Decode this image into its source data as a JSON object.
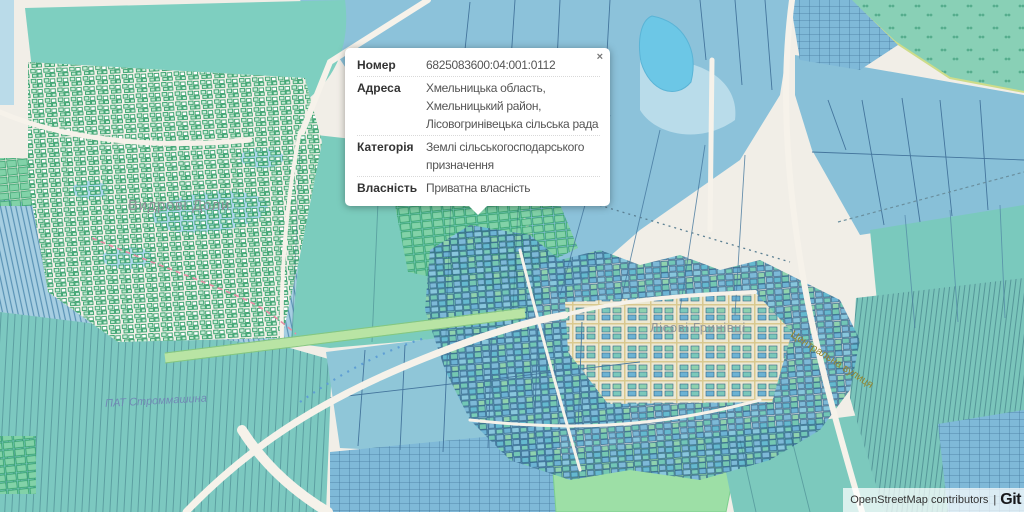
{
  "popup": {
    "close_label": "×",
    "rows": [
      {
        "label": "Номер",
        "value": "6825083600:04:001:0112"
      },
      {
        "label": "Адреса",
        "value": "Хмельницька область, Хмельницький район, Лісовогринівецька сільська рада"
      },
      {
        "label": "Категорія",
        "value": "Землі сільськогосподарського призначення"
      },
      {
        "label": "Власність",
        "value": "Приватна власність"
      }
    ]
  },
  "map_labels": {
    "settlement_west": "Видрові Доли",
    "factory": "ПАТ Строммашина",
    "settlement_central": "Лісові Гринівці",
    "street": "Центральна вулиця"
  },
  "attribution": {
    "osm": "OpenStreetMap contributors",
    "separator": "|",
    "brand": "Git"
  },
  "colors": {
    "background": "#f1eee7",
    "parcel_teal": "#7bccbd",
    "parcel_blue": "#8cc2da",
    "parcel_green": "#82d2a8",
    "forest_green": "#89d0b6",
    "water": "#6cc7e6",
    "parcel_border": "#44759c",
    "boundary_pink": "#e78da4",
    "popup_background": "#ffffff"
  }
}
